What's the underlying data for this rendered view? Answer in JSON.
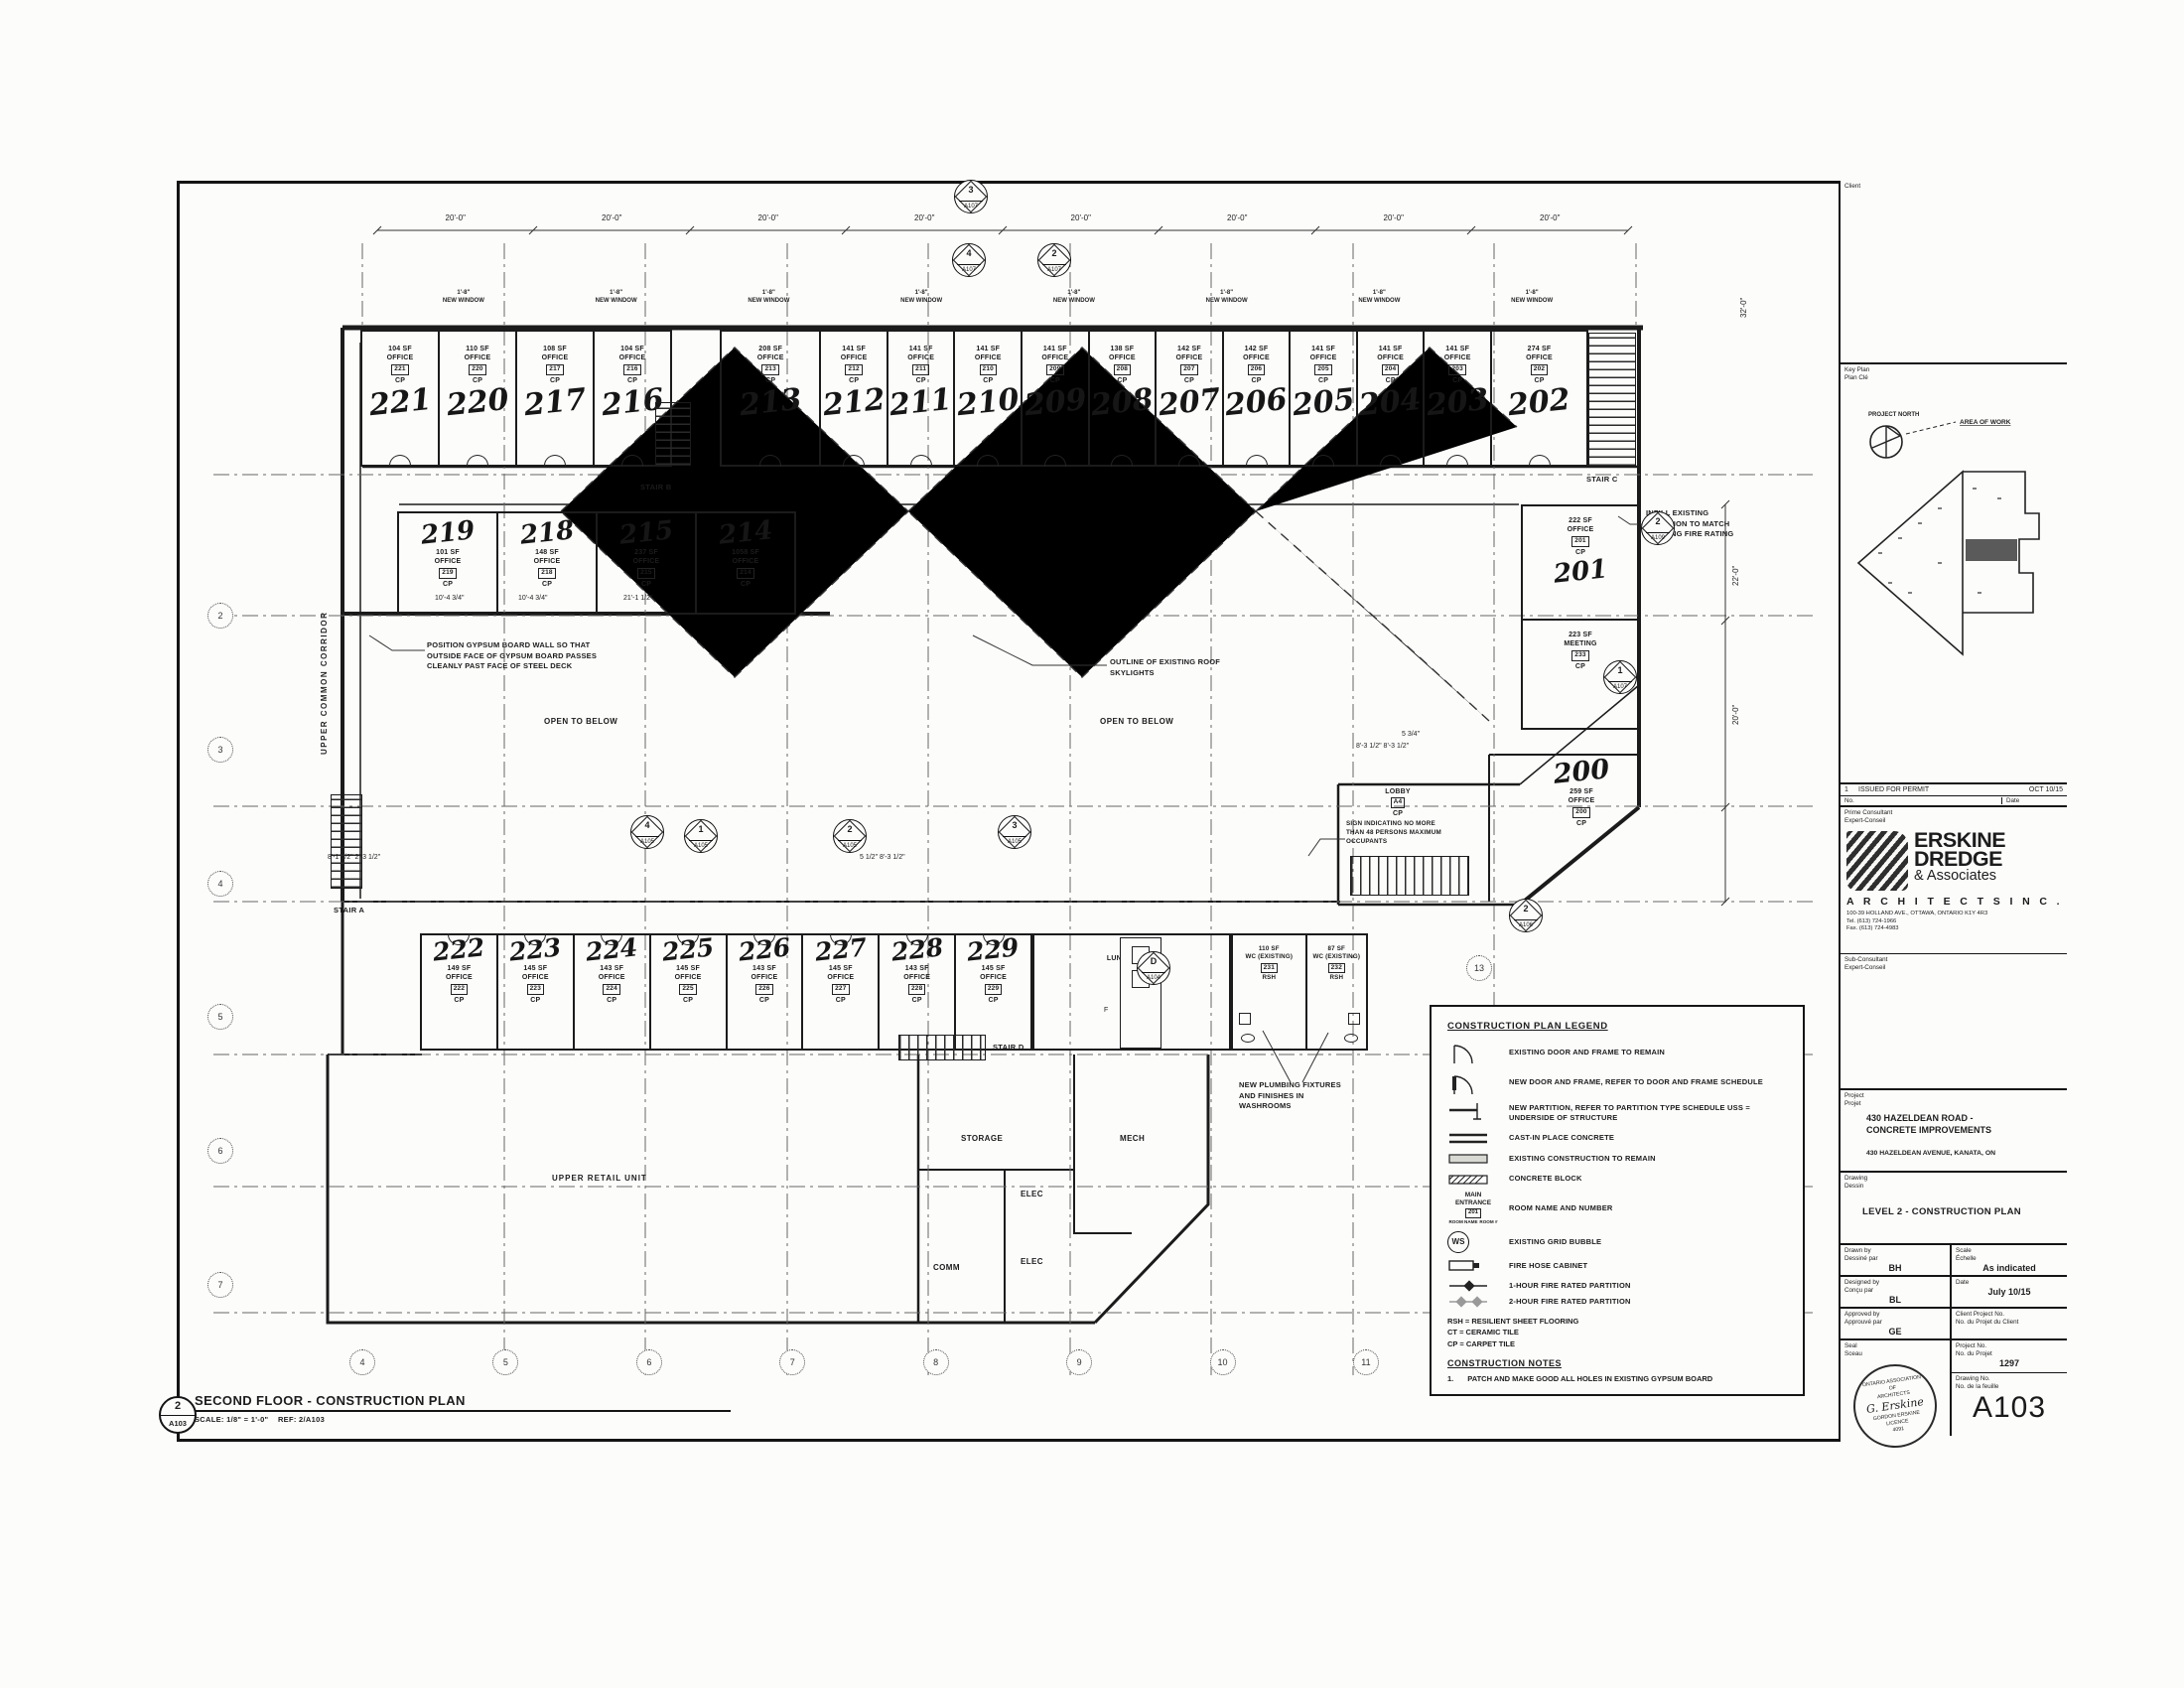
{
  "plan_title": {
    "marker_no": "2",
    "marker_sheet": "A103",
    "title": "SECOND FLOOR - CONSTRUCTION PLAN",
    "scale": "SCALE:  1/8\" = 1'-0\"",
    "ref": "REF: 2/A103"
  },
  "plan": {
    "top_dims": [
      {
        "v": "20'-0\""
      },
      {
        "v": "20'-0\""
      },
      {
        "v": "20'-0\""
      },
      {
        "v": "20'-0\""
      },
      {
        "v": "20'-0\""
      },
      {
        "v": "20'-0\""
      },
      {
        "v": "20'-0\""
      },
      {
        "v": "20'-0\""
      }
    ],
    "windows": [
      {
        "d": "1'-8\"",
        "l": "NEW WINDOW"
      },
      {
        "d": "1'-8\"",
        "l": "NEW WINDOW"
      },
      {
        "d": "1'-8\"",
        "l": "NEW WINDOW"
      },
      {
        "d": "1'-8\"",
        "l": "NEW WINDOW"
      },
      {
        "d": "1'-8\"",
        "l": "NEW WINDOW"
      },
      {
        "d": "1'-8\"",
        "l": "NEW WINDOW"
      },
      {
        "d": "1'-8\"",
        "l": "NEW WINDOW"
      },
      {
        "d": "1'-8\"",
        "l": "NEW WINDOW"
      }
    ],
    "top_rooms_a": [
      {
        "num": "221",
        "area": "104 SF",
        "type": "OFFICE",
        "tag": "221",
        "fin": "CP"
      },
      {
        "num": "220",
        "area": "110 SF",
        "type": "OFFICE",
        "tag": "220",
        "fin": "CP"
      },
      {
        "num": "217",
        "area": "108 SF",
        "type": "OFFICE",
        "tag": "217",
        "fin": "CP"
      },
      {
        "num": "216",
        "area": "104 SF",
        "type": "OFFICE",
        "tag": "216",
        "fin": "CP"
      }
    ],
    "top_rooms_b": [
      {
        "num": "213",
        "area": "208 SF",
        "type": "OFFICE",
        "tag": "213",
        "fin": "CP"
      },
      {
        "num": "212",
        "area": "141 SF",
        "type": "OFFICE",
        "tag": "212",
        "fin": "CP"
      },
      {
        "num": "211",
        "area": "141 SF",
        "type": "OFFICE",
        "tag": "211",
        "fin": "CP"
      },
      {
        "num": "210",
        "area": "141 SF",
        "type": "OFFICE",
        "tag": "210",
        "fin": "CP"
      },
      {
        "num": "209",
        "area": "141 SF",
        "type": "OFFICE",
        "tag": "209",
        "fin": "CP"
      },
      {
        "num": "208",
        "area": "138 SF",
        "type": "OFFICE",
        "tag": "208",
        "fin": "CP"
      },
      {
        "num": "207",
        "area": "142 SF",
        "type": "OFFICE",
        "tag": "207",
        "fin": "CP"
      },
      {
        "num": "206",
        "area": "142 SF",
        "type": "OFFICE",
        "tag": "206",
        "fin": "CP"
      },
      {
        "num": "205",
        "area": "141 SF",
        "type": "OFFICE",
        "tag": "205",
        "fin": "CP"
      },
      {
        "num": "204",
        "area": "141 SF",
        "type": "OFFICE",
        "tag": "204",
        "fin": "CP"
      },
      {
        "num": "203",
        "area": "141 SF",
        "type": "OFFICE",
        "tag": "203",
        "fin": "CP"
      },
      {
        "num": "202",
        "area": "274 SF",
        "type": "OFFICE",
        "tag": "202",
        "fin": "CP"
      }
    ],
    "band2_rooms": [
      {
        "num": "219",
        "area": "101 SF",
        "type": "OFFICE",
        "tag": "219",
        "fin": "CP"
      },
      {
        "num": "218",
        "area": "148 SF",
        "type": "OFFICE",
        "tag": "218",
        "fin": "CP"
      },
      {
        "num": "215",
        "area": "237 SF",
        "type": "OFFICE",
        "tag": "215",
        "fin": "CP"
      },
      {
        "num": "214",
        "area": "1058 SF",
        "type": "OFFICE",
        "tag": "214",
        "fin": "CP"
      }
    ],
    "right_rooms": [
      {
        "num": "201",
        "area": "222 SF",
        "type": "OFFICE",
        "tag": "201",
        "fin": "CP"
      },
      {
        "num": "",
        "area": "223 SF",
        "type": "MEETING",
        "tag": "233",
        "fin": "CP"
      }
    ],
    "room200": {
      "num": "200",
      "area": "259 SF",
      "type": "OFFICE",
      "tag": "200",
      "fin": "CP"
    },
    "lobby": {
      "name": "LOBBY",
      "tag": "A4",
      "fin": "CP"
    },
    "bottom_rooms": [
      {
        "num": "222",
        "area": "149 SF",
        "type": "OFFICE",
        "tag": "222",
        "fin": "CP"
      },
      {
        "num": "223",
        "area": "145 SF",
        "type": "OFFICE",
        "tag": "223",
        "fin": "CP"
      },
      {
        "num": "224",
        "area": "143 SF",
        "type": "OFFICE",
        "tag": "224",
        "fin": "CP"
      },
      {
        "num": "225",
        "area": "145 SF",
        "type": "OFFICE",
        "tag": "225",
        "fin": "CP"
      },
      {
        "num": "226",
        "area": "143 SF",
        "type": "OFFICE",
        "tag": "226",
        "fin": "CP"
      },
      {
        "num": "227",
        "area": "145 SF",
        "type": "OFFICE",
        "tag": "227",
        "fin": "CP"
      },
      {
        "num": "228",
        "area": "143 SF",
        "type": "OFFICE",
        "tag": "228",
        "fin": "CP"
      },
      {
        "num": "229",
        "area": "145 SF",
        "type": "OFFICE",
        "tag": "229",
        "fin": "CP"
      }
    ],
    "lunch": {
      "area": "408 SF",
      "name": "LUNCH ROOM",
      "tag": "230",
      "fin": "RSH"
    },
    "wcs": [
      {
        "area": "110 SF",
        "name": "WC (EXISTING)",
        "tag": "231",
        "fin": "RSH"
      },
      {
        "area": "87 SF",
        "name": "WC (EXISTING)",
        "tag": "232",
        "fin": "RSH"
      }
    ],
    "shaft_label": "F",
    "stairs": {
      "a": "STAIR A",
      "b": "STAIR B",
      "c": "STAIR C",
      "d": "STAIR D"
    },
    "corridor": "UPPER COMMON CORRIDOR",
    "open1": "OPEN TO BELOW",
    "open2": "OPEN TO BELOW",
    "retail": "UPPER RETAIL UNIT",
    "service": {
      "storage": "STORAGE",
      "mech": "MECH",
      "elec1": "ELEC",
      "comm": "COMM",
      "elec2": "ELEC"
    },
    "notes": {
      "gypsum": "POSITION GYPSUM BOARD WALL SO THAT OUTSIDE FACE OF GYPSUM BOARD PASSES CLEANLY PAST FACE OF STEEL DECK",
      "skylight": "OUTLINE OF EXISTING ROOF SKYLIGHTS",
      "sign": "SIGN INDICATING NO MORE THAN 48 PERSONS MAXIMUM OCCUPANTS",
      "infill": "INFILL EXISTING PARTITION TO MATCH EXISTING FIRE RATING",
      "plumbing": "NEW PLUMBING FIXTURES AND FINISHES IN WASHROOMS"
    },
    "markers": [
      {
        "no": "3",
        "sheet": "A107"
      },
      {
        "no": "4",
        "sheet": "A107"
      },
      {
        "no": "2",
        "sheet": "A107"
      },
      {
        "no": "4",
        "sheet": "A105"
      },
      {
        "no": "1",
        "sheet": "A105"
      },
      {
        "no": "2",
        "sheet": "A105"
      },
      {
        "no": "3",
        "sheet": "A105"
      },
      {
        "no": "2",
        "sheet": "A109"
      },
      {
        "no": "1",
        "sheet": "A107"
      },
      {
        "no": "2",
        "sheet": "A106"
      },
      {
        "no": "D",
        "sheet": "A104"
      }
    ],
    "grid": {
      "bottom": [
        {
          "v": "4"
        },
        {
          "v": "5"
        },
        {
          "v": "6"
        },
        {
          "v": "7"
        },
        {
          "v": "8"
        },
        {
          "v": "9"
        },
        {
          "v": "10"
        },
        {
          "v": "11"
        }
      ],
      "left": [
        {
          "v": "2"
        },
        {
          "v": "3"
        },
        {
          "v": "4"
        },
        {
          "v": "5"
        },
        {
          "v": "6"
        },
        {
          "v": "7"
        }
      ],
      "right13": "13"
    },
    "dims": {
      "c1": "10'-4 3/4\"",
      "c2": "10'-4 3/4\"",
      "c3": "21'-1 1/2\"",
      "lob": "8'-3 1/2\"   8'-3 1/2\"",
      "lob2": "5 3/4\"",
      "bl": "8'-1 1/2\"  2'-3 1/2\"",
      "bc": "5 1/2\"  8'-3 1/2\"",
      "r1": "22'-0\"",
      "r2": "20'-0\"",
      "r3": "32'-0\""
    }
  },
  "legend": {
    "title": "CONSTRUCTION PLAN LEGEND",
    "items": [
      {
        "text": "EXISTING DOOR AND FRAME TO REMAIN"
      },
      {
        "text": "NEW DOOR AND FRAME, REFER TO DOOR AND FRAME SCHEDULE"
      },
      {
        "text": "NEW PARTITION, REFER TO PARTITION TYPE SCHEDULE  USS = UNDERSIDE OF STRUCTURE"
      },
      {
        "text": "CAST-IN PLACE CONCRETE"
      },
      {
        "text": "EXISTING CONSTRUCTION TO REMAIN"
      },
      {
        "text": "CONCRETE BLOCK"
      },
      {
        "text": "ROOM NAME AND NUMBER"
      },
      {
        "text": "EXISTING GRID BUBBLE"
      },
      {
        "text": "FIRE HOSE CABINET"
      },
      {
        "text": "1-HOUR FIRE RATED PARTITION"
      },
      {
        "text": "2-HOUR FIRE RATED PARTITION"
      }
    ],
    "entrance_sample": {
      "main": "MAIN ENTRANCE",
      "tag": "201",
      "sub1": "ROOM NAME",
      "sub2": "ROOM #"
    },
    "ws_glyph": "WS",
    "abbr": [
      "RSH  =  RESILIENT SHEET FLOORING",
      "CT  =  CERAMIC TILE",
      "CP  =  CARPET TILE"
    ],
    "notes_title": "CONSTRUCTION NOTES",
    "note_no": "1.",
    "note_text": "PATCH AND MAKE GOOD ALL HOLES IN EXISTING GYPSUM BOARD"
  },
  "titleblock": {
    "client_label": "Client",
    "keyplan_label": "Key Plan",
    "keyplan_label_fr": "Plan Clé",
    "north_label": "PROJECT NORTH",
    "area_label": "AREA OF WORK",
    "rev": {
      "no": "1",
      "desc": "ISSUED FOR PERMIT",
      "date": "OCT 10/15"
    },
    "rev_head_no": "No.",
    "rev_head_date": "Date",
    "prime_label": "Prime Consultant",
    "prime_label_fr": "Expert-Conseil",
    "firm": {
      "l1": "ERSKINE",
      "l2": "DREDGE",
      "l3": "& Associates",
      "l4": "A R C H I T E C T S   I N C .",
      "addr1": "100-39 HOLLAND AVE., OTTAWA, ONTARIO K1Y 4R3",
      "addr2": "Tel.  (613) 724-1966",
      "addr3": "Fax. (613) 724-4983"
    },
    "sub_label": "Sub-Consultant",
    "sub_label_fr": "Expert-Conseil",
    "project_label": "Project",
    "project_label_fr": "Projet",
    "project_l1": "430 HAZELDEAN ROAD -",
    "project_l2": "CONCRETE IMPROVEMENTS",
    "project_addr": "430 HAZELDEAN AVENUE, KANATA, ON",
    "drawing_label": "Drawing",
    "drawing_label_fr": "Dessin",
    "drawing_title": "LEVEL 2 - CONSTRUCTION PLAN",
    "drawn_label": "Drawn by",
    "drawn_label_fr": "Dessiné par",
    "drawn": "BH",
    "scale_label": "Scale",
    "scale_label_fr": "Échelle",
    "scale": "As indicated",
    "designed_label": "Designed by",
    "designed_label_fr": "Conçu par",
    "designed": "BL",
    "date_label": "Date",
    "date": "July 10/15",
    "approved_label": "Approved by",
    "approved_label_fr": "Approuvé par",
    "approved": "GE",
    "clientno_label": "Client Project No.",
    "clientno_label_fr": "No. du Projet du Client",
    "clientno": "",
    "seal_label": "Seal",
    "seal_label_fr": "Sceau",
    "projno_label": "Project No.",
    "projno_label_fr": "No. du Projet",
    "projno": "1297",
    "dwgno_label": "Drawing No.",
    "dwgno_label_fr": "No. de la feuille",
    "dwgno": "A103",
    "stamp": {
      "l1": "ONTARIO ASSOCIATION",
      "l2": "OF",
      "l3": "ARCHITECTS",
      "sig": "G. Erskine",
      "l4": "GORDON ERSKINE",
      "l5": "LICENCE",
      "l6": "4091"
    }
  }
}
